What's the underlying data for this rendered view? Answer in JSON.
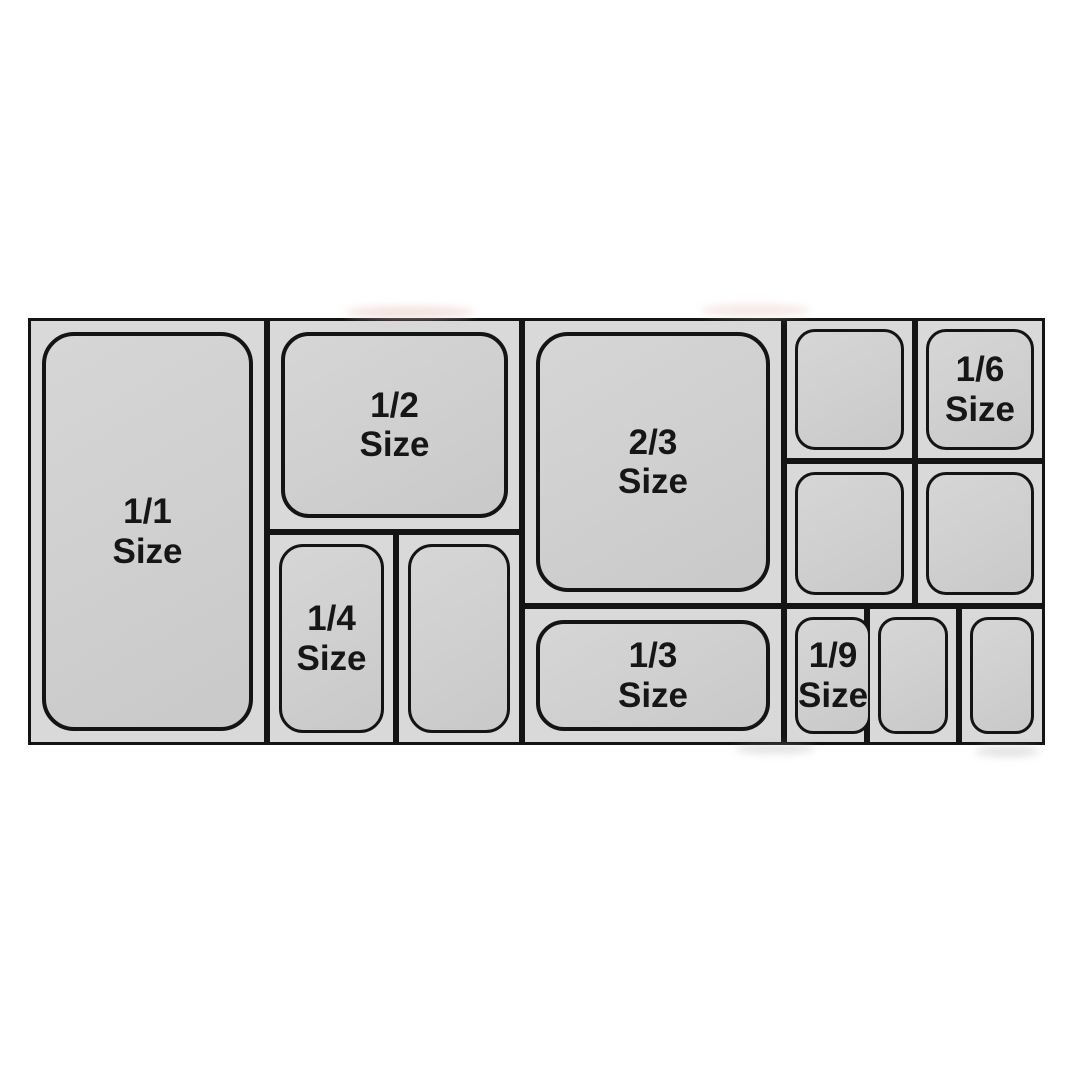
{
  "diagram": {
    "colors": {
      "page_background": "#ffffff",
      "divider_border": "#141414",
      "cell_background": "#d9d9d9",
      "pan_fill": "#cfcfcf",
      "label_text": "#161616"
    },
    "pans": [
      {
        "name": "full-size",
        "label": "1/1\nSize"
      },
      {
        "name": "half-size",
        "label": "1/2\nSize"
      },
      {
        "name": "quarter-size-labeled",
        "label": "1/4\nSize"
      },
      {
        "name": "quarter-size-unlabeled",
        "label": ""
      },
      {
        "name": "two-thirds-size",
        "label": "2/3\nSize"
      },
      {
        "name": "third-size",
        "label": "1/3\nSize"
      },
      {
        "name": "sixth-size-unlabeled-top",
        "label": ""
      },
      {
        "name": "sixth-size-labeled",
        "label": "1/6\nSize"
      },
      {
        "name": "sixth-size-unlabeled-mid-left",
        "label": ""
      },
      {
        "name": "sixth-size-unlabeled-mid-right",
        "label": ""
      },
      {
        "name": "ninth-size-labeled",
        "label": "1/9\nSize"
      },
      {
        "name": "ninth-size-unlabeled-mid",
        "label": ""
      },
      {
        "name": "ninth-size-unlabeled-right",
        "label": ""
      }
    ]
  }
}
